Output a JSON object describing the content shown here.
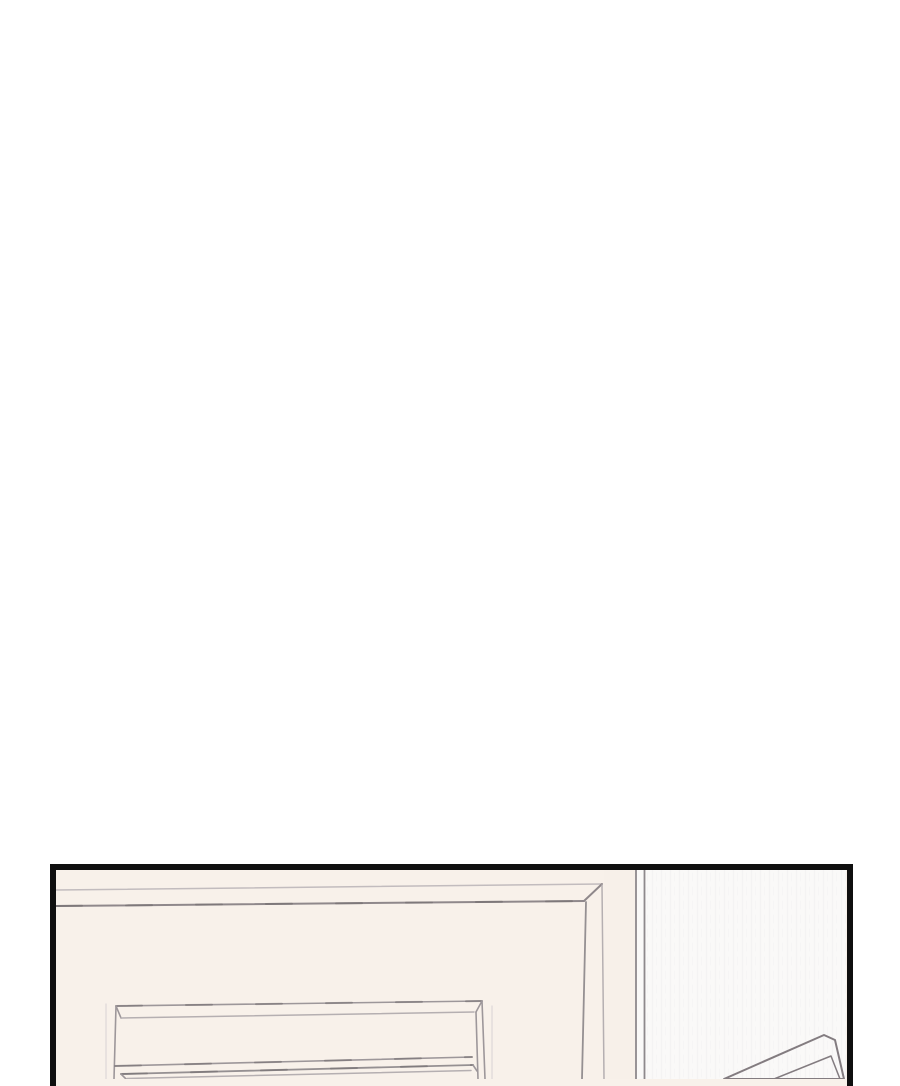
{
  "scene": {
    "panel_aria_label": "Webtoon comic panel: top corner of a cream wardrobe with two drawers standing against a pale wall; the corner of another beige and gray furniture piece enters from the lower right",
    "objects": {
      "wardrobe": "wardrobe-cabinet",
      "upper_drawer": "upper-drawer",
      "lower_drawer": "lower-drawer",
      "wall": "bedroom-wall",
      "wall_corner": "wall-corner-trim",
      "corner_object": "furniture-corner"
    }
  },
  "palette": {
    "page_bg": "#ffffff",
    "panel_border": "#0f0f0f",
    "cabinet_cream": "#f8f1ea",
    "cabinet_side": "#f7f0e9",
    "wall_white": "#faf9f8",
    "line_dark": "#8f888b",
    "line_mid": "#9d979a",
    "line_light": "#b5afb1",
    "line_back": "#c2bcbe",
    "wall_line": "#8e898c",
    "object_outline": "#837c80",
    "object_beige": "#ded4cc",
    "object_gray": "#b4b2bb"
  }
}
